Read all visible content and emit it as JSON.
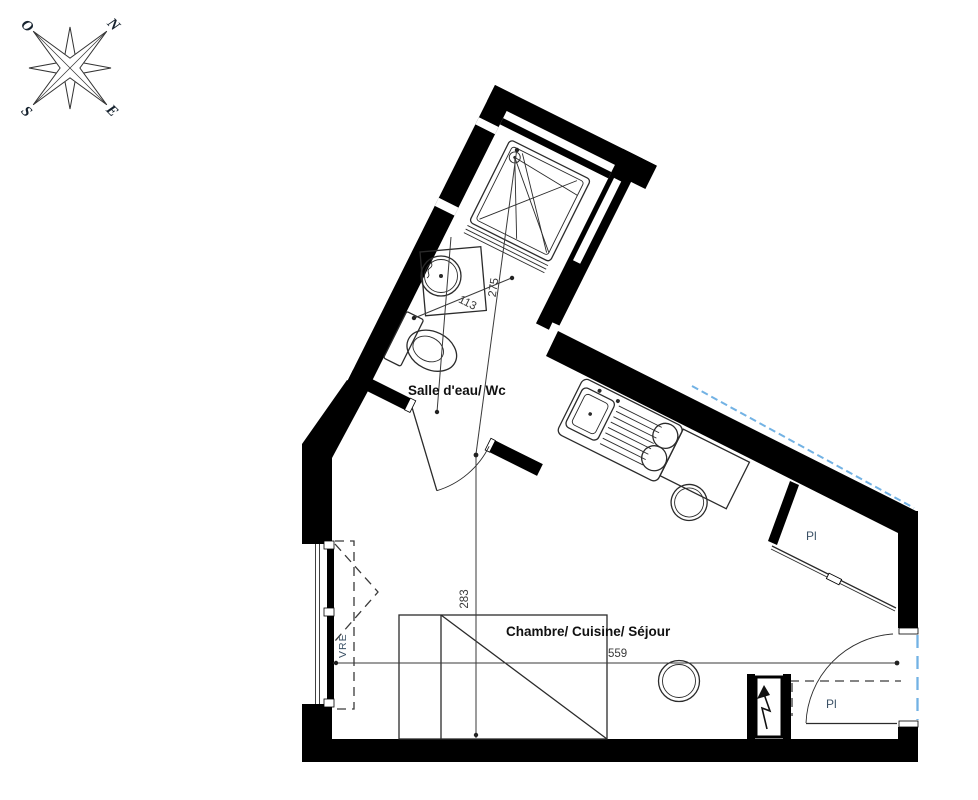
{
  "compass": {
    "north": "N",
    "south": "S",
    "east": "E",
    "west": "O"
  },
  "rooms": {
    "bathroom": "Salle d'eau/ Wc",
    "main": "Chambre/ Cuisine/ Séjour"
  },
  "openings": {
    "window_label": "VRE",
    "closet_upper": "Pl",
    "closet_lower": "Pl"
  },
  "dimensions": {
    "bathroom_width": "113",
    "bathroom_length": "275",
    "main_depth": "283",
    "main_width": "559"
  },
  "colors": {
    "wall": "#000000",
    "dimension": "#3a3a3a",
    "accent_blue": "#72b2e4",
    "label_blue": "#3b5166"
  }
}
